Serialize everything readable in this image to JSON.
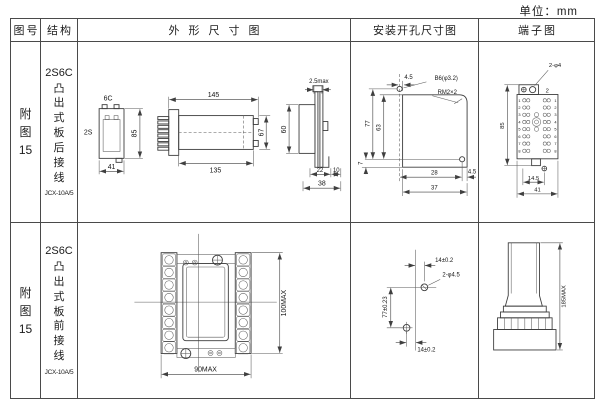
{
  "unit_label": "单位：mm",
  "headers": {
    "fig_no": "图号",
    "structure": "结构",
    "outline": "外形尺寸图",
    "mounting": "安装开孔尺寸图",
    "terminal": "端子图"
  },
  "row1": {
    "fig_no": "附图15",
    "model": "2S6C",
    "desc": "凸出式板后接线",
    "code": "JCX-10A/5",
    "outline": {
      "front": {
        "label_top": "6C",
        "label_left": "2S",
        "dim_h": "85",
        "dim_w": "41"
      },
      "side": {
        "dim_top": "145",
        "dim_bottom": "135",
        "dim_h": "67"
      },
      "panel": {
        "dim_top": "2.5max",
        "dim_h": "60",
        "dim_a": "22",
        "dim_b": "10",
        "dim_w": "38"
      }
    },
    "mounting": {
      "dim_top": "4.5",
      "label_hole": "B6(φ3.2)",
      "label_thread": "RM2×2",
      "dim_outer": "77",
      "dim_inner": "63",
      "dim_foot": "7",
      "dim_hole_x": "28",
      "dim_right": "4.5",
      "dim_w": "37"
    },
    "terminal": {
      "label_holes": "2-φ4",
      "label_count": "2",
      "dim_h": "85",
      "dim_a": "14.5",
      "dim_w": "41",
      "numbers": [
        "1",
        "2",
        "3",
        "4",
        "5",
        "6",
        "7",
        "8"
      ]
    }
  },
  "row2": {
    "fig_no": "附图15",
    "model": "2S6C",
    "desc": "凸出式板前接线",
    "code": "JCX-10A/5",
    "outline": {
      "dim_h": "100MAX",
      "dim_w": "90MAX"
    },
    "mounting": {
      "dim_top": "14±0.2",
      "label_holes": "2-φ4.5",
      "dim_v": "77±0.23",
      "dim_bottom": "14±0.2"
    },
    "terminal": {
      "dim_h": "185MAX"
    }
  }
}
